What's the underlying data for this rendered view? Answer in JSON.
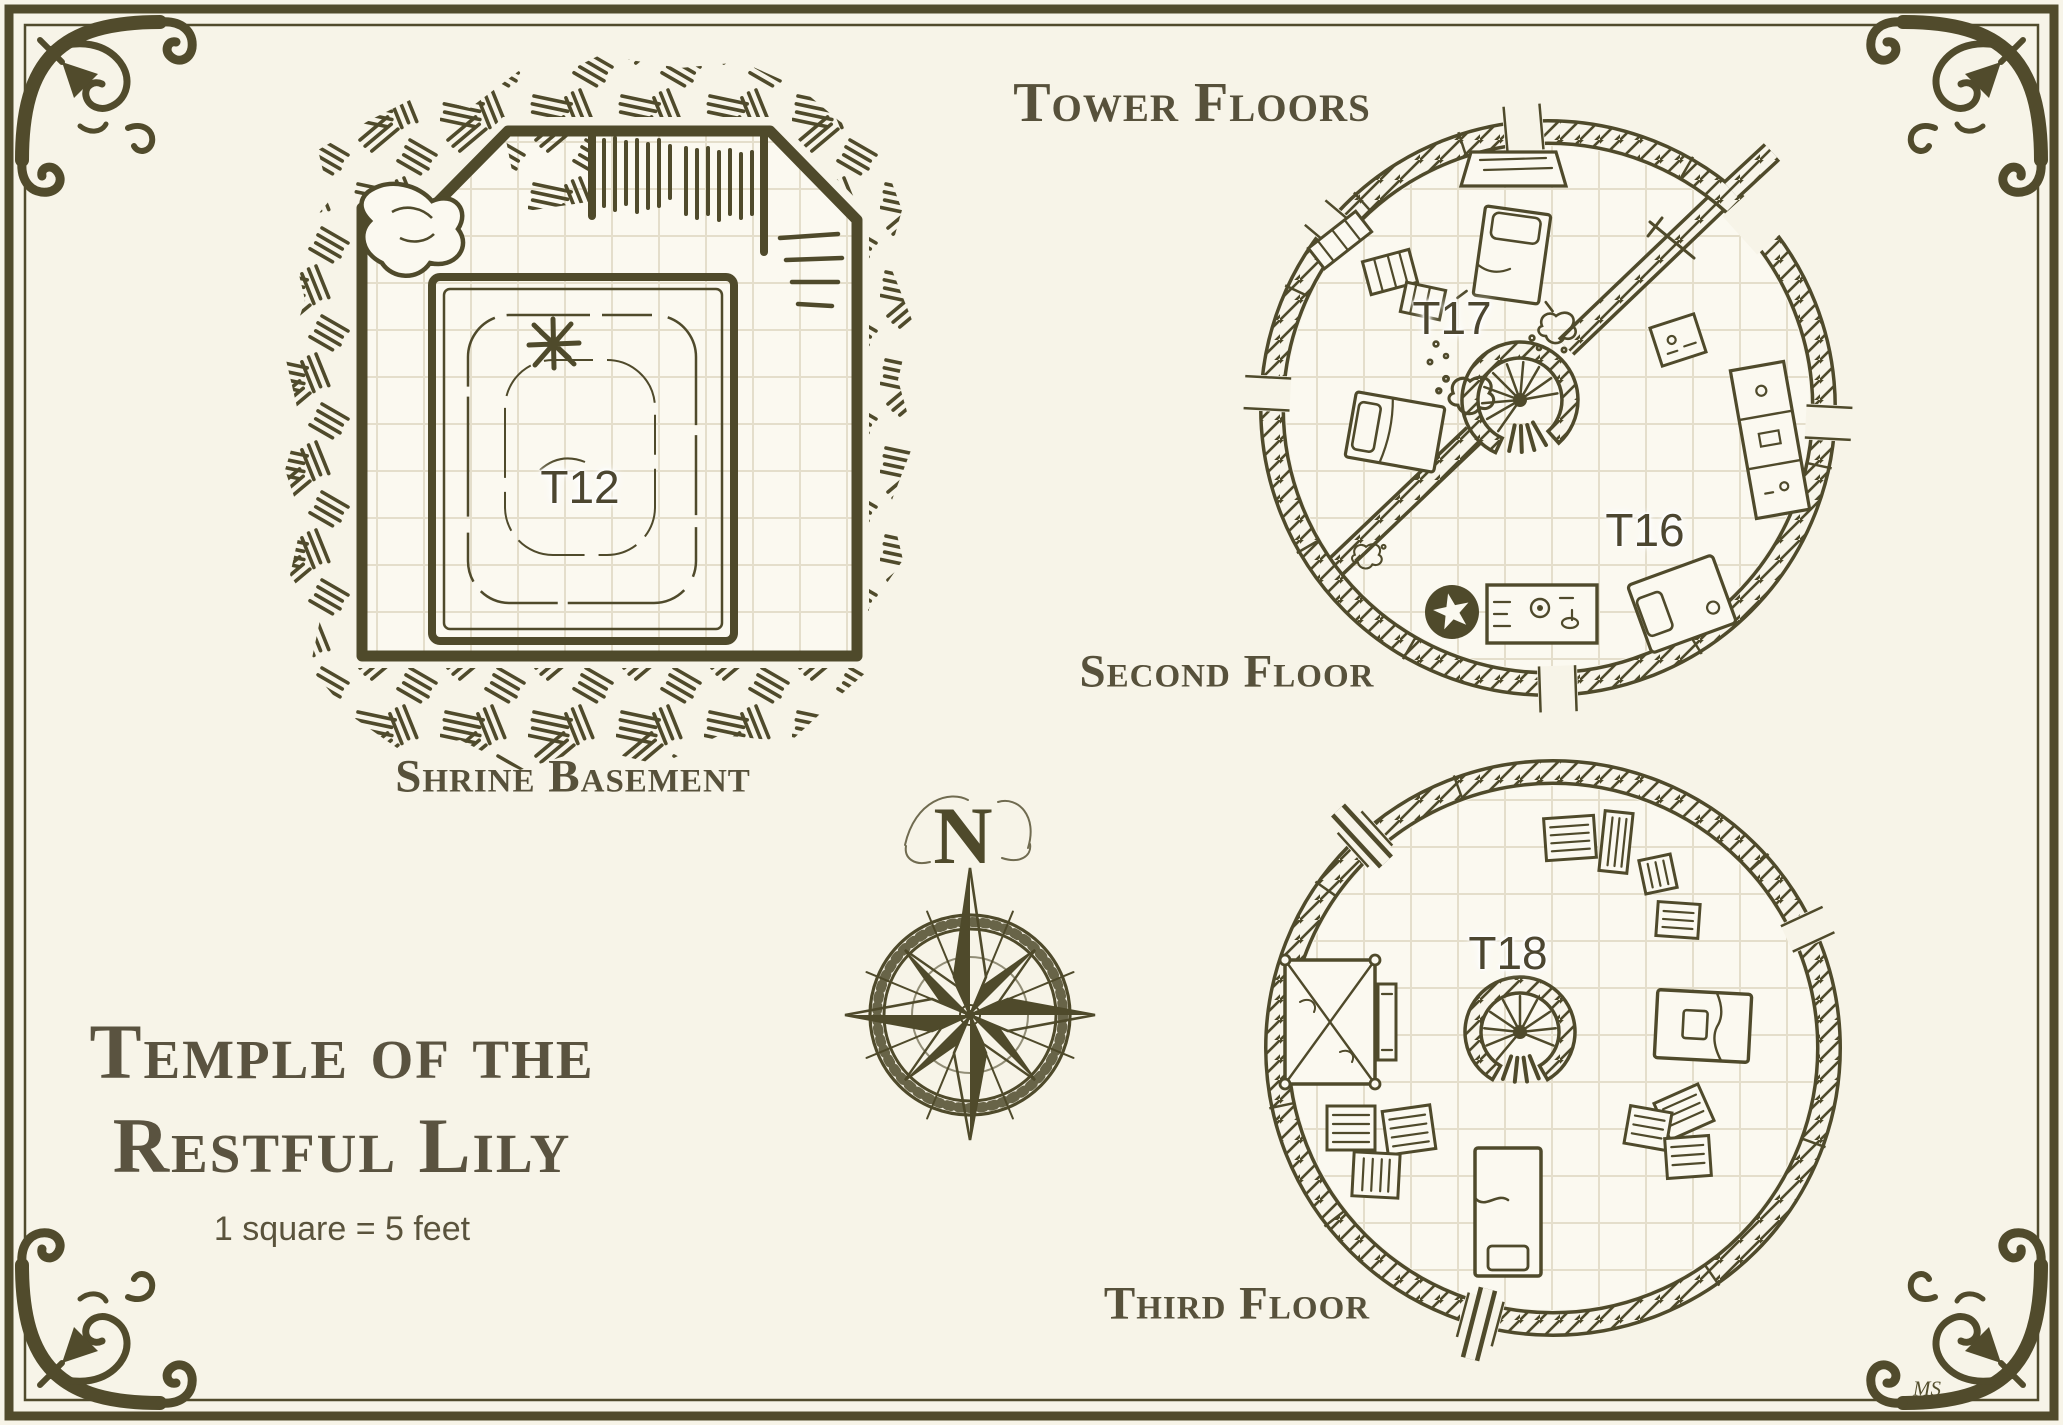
{
  "palette": {
    "background": "#f7f4e8",
    "ink": "#4f4a2b",
    "heading_text": "#57513b",
    "grid_line": "#e4decb",
    "floor_fill": "#fbf9f0"
  },
  "header": {
    "section_title": "Tower Floors"
  },
  "title": {
    "line1": "Temple of the",
    "line2": "Restful Lily",
    "scale_note": "1 square = 5 feet"
  },
  "maps": {
    "shrine_basement": {
      "caption": "Shrine Basement",
      "room_label": "T12"
    },
    "second_floor": {
      "caption": "Second Floor",
      "room_labels": [
        "T17",
        "T16"
      ]
    },
    "third_floor": {
      "caption": "Third Floor",
      "room_label": "T18"
    }
  },
  "compass": {
    "north_label": "N"
  },
  "icons": {
    "star_marker_icon": "★",
    "compass_rose_icon": "✦"
  },
  "artist_signature": "MS"
}
